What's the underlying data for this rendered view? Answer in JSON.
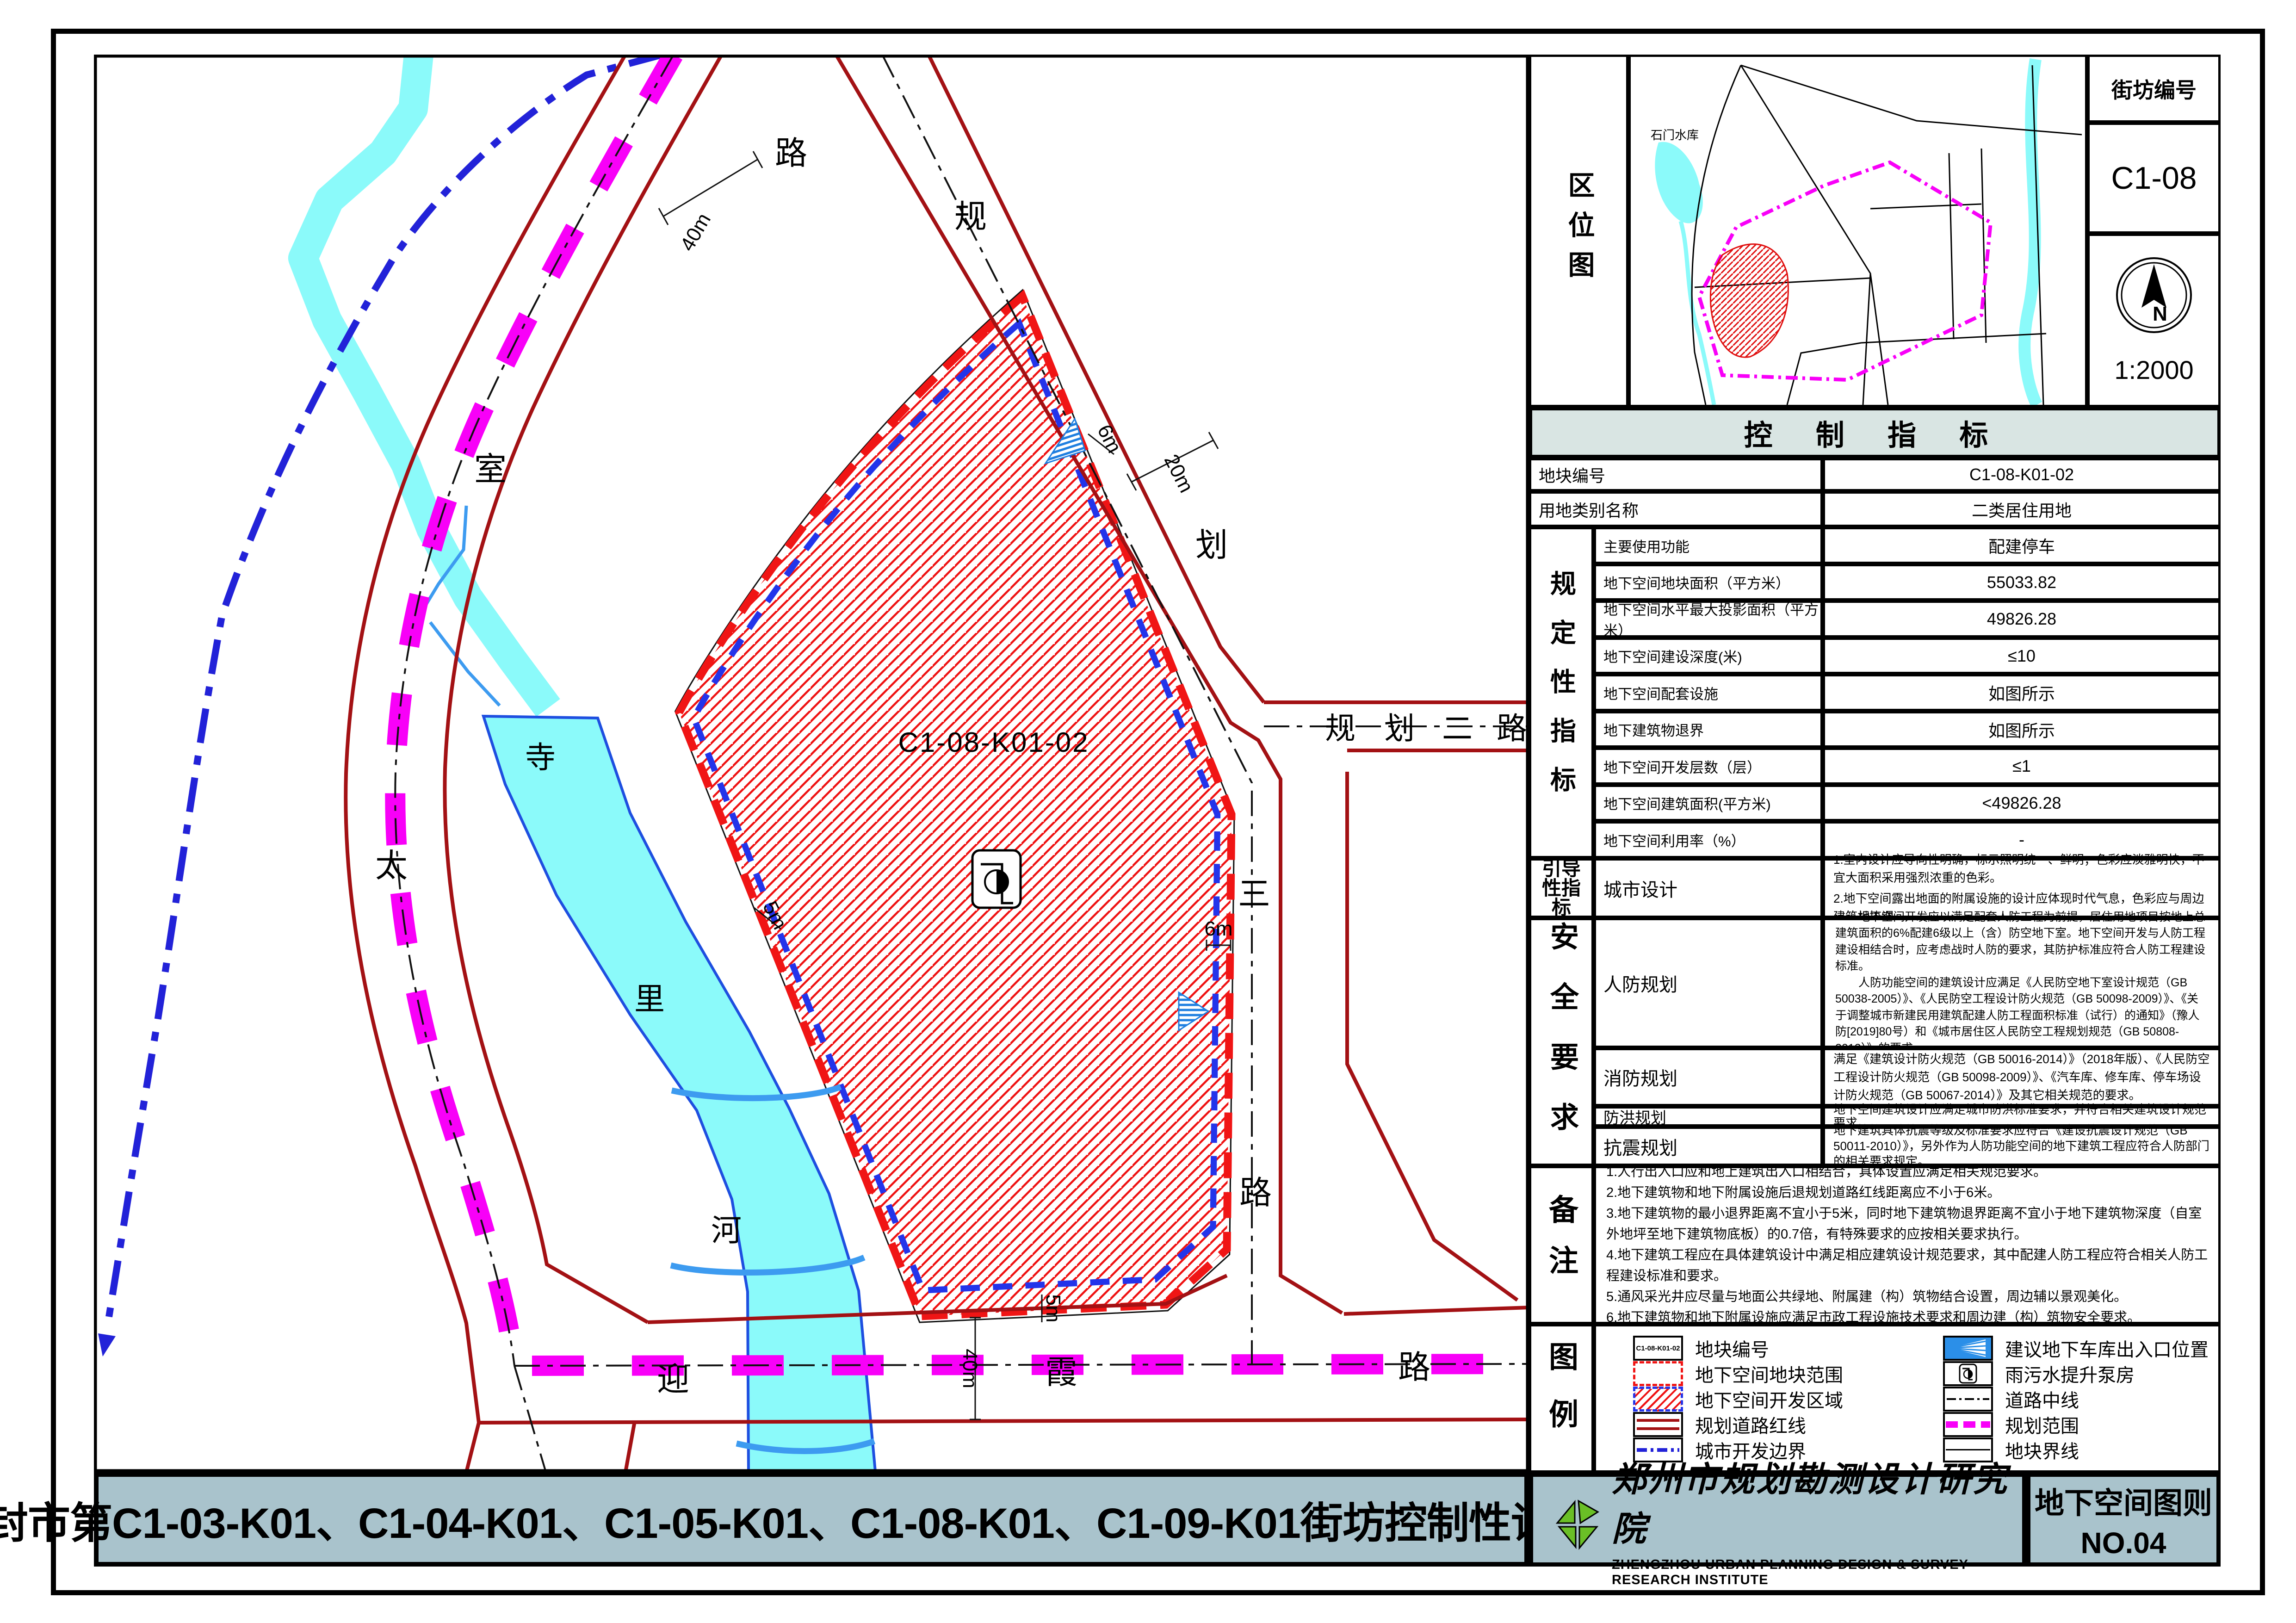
{
  "sheet": {
    "title_bar": "登封市第C1-03-K01、C1-04-K01、C1-05-K01、C1-08-K01、C1-09-K01街坊控制性详细规划",
    "footer": {
      "institute_cn": "郑州市规划勘测设计研究院",
      "institute_en": "ZHENGZHOU URBAN PLANNING DESIGN & SURVEY RESEARCH INSTITUTE",
      "sheet_name": "地下空间图则",
      "sheet_no": "NO.04"
    }
  },
  "location_map": {
    "label": "区位图",
    "block_no_label": "街坊编号",
    "block_no": "C1-08",
    "north_letter": "N",
    "scale": "1:2000",
    "reservoir": "石门水库"
  },
  "map": {
    "parcel_code": "C1-08-K01-02",
    "river_chars": [
      "寺",
      "里",
      "河"
    ],
    "taishi_road_chars": [
      "太",
      "室",
      "路"
    ],
    "guihua3_road_chars": [
      "规",
      "划",
      "三",
      "路"
    ],
    "guihua2_road_chars": [
      "规",
      "划",
      "二",
      "路"
    ],
    "yingxia_road_chars": [
      "迎",
      "霞",
      "路"
    ],
    "dims": {
      "d40_top": "40m",
      "d20": "20m",
      "d6_ne": "6m",
      "d6_e": "6m",
      "d5_w": "5m",
      "d5_s": "5m",
      "d40_bottom": "40m"
    }
  },
  "table": {
    "header": "控  制  指  标",
    "row_plot_no": {
      "label": "地块编号",
      "value": "C1-08-K01-02"
    },
    "row_landuse": {
      "label": "用地类别名称",
      "value": "二类居住用地"
    },
    "group_regulatory": "规定性指标",
    "spec_rows": [
      {
        "label": "主要使用功能",
        "value": "配建停车"
      },
      {
        "label": "地下空间地块面积（平方米）",
        "value": "55033.82"
      },
      {
        "label": "地下空间水平最大投影面积（平方米）",
        "value": "49826.28"
      },
      {
        "label": "地下空间建设深度(米)",
        "value": "≤10"
      },
      {
        "label": "地下空间配套设施",
        "value": "如图所示"
      },
      {
        "label": "地下建筑物退界",
        "value": "如图所示"
      },
      {
        "label": "地下空间开发层数（层）",
        "value": "≤1"
      },
      {
        "label": "地下空间建筑面积(平方米)",
        "value": "<49826.28"
      },
      {
        "label": "地下空间利用率（%）",
        "value": "-"
      }
    ],
    "group_guiding": "引导性指标",
    "urban_design": {
      "label": "城市设计",
      "line1": "1.室内设计应导向性明确，标示照明统一、鲜明；色彩应淡雅明快，不宜大面积采用强烈浓重的色彩。",
      "line2": "2.地下空间露出地面的附属设施的设计应体现时代气息，色彩应与周边建筑相协调。"
    },
    "group_safety": "安全要求",
    "civil_defense": {
      "label": "人防规划",
      "p1": "地下空间开发应以满足配套人防工程为前提，居住用地项目按地上总建筑面积的6%配建6级以上（含）防空地下室。地下空间开发与人防工程建设相结合时，应考虑战时人防的要求，其防护标准应符合人防工程建设标准。",
      "p2": "人防功能空间的建筑设计应满足《人民防空地下室设计规范（GB 50038-2005）》、《人民防空工程设计防火规范（GB 50098-2009）》、《关于调整城市新建民用建筑配建人防工程面积标准（试行）的通知》（豫人防[2019]80号）和《城市居住区人民防空工程规划规范（GB 50808-2013）》的要求。"
    },
    "fire": {
      "label": "消防规划",
      "text": "满足《建筑设计防火规范（GB 50016-2014）》（2018年版）、《人民防空工程设计防火规范（GB 50098-2009）》、《汽车库、修车库、停车场设计防火规范（GB 50067-2014）》及其它相关规范的要求。"
    },
    "flood": {
      "label": "防洪规划",
      "text": "地下空间建筑设计应满足城市防洪标准要求，并符合相关建筑设计规范要求。"
    },
    "seismic": {
      "label": "抗震规划",
      "text": "地下建筑具体抗震等级及标准要求应符合《建设抗震设计规范（GB 50011-2010）》，另外作为人防功能空间的地下建筑工程应符合人防部门的相关要求规定。"
    },
    "group_remarks": "备注",
    "remarks": [
      "1.人行出入口应和地上建筑出入口相结合，具体设置应满足相关规范要求。",
      "2.地下建筑物和地下附属设施后退规划道路红线距离应不小于6米。",
      "3.地下建筑物的最小退界距离不宜小于5米，同时地下建筑物退界距离不宜小于地下建筑物深度（自室外地坪至地下建筑物底板）的0.7倍，有特殊要求的应按相关要求执行。",
      "4.地下建筑工程应在具体建筑设计中满足相应建筑设计规范要求，其中配建人防工程应符合相关人防工程建设标准和要求。",
      "5.通风采光井应尽量与地面公共绿地、附属建（构）筑物结合设置，周边辅以景观美化。",
      "6.地下建筑物和地下附属设施应满足市政工程设施技术要求和周边建（构）筑物安全要求。"
    ],
    "group_legend": "图例",
    "legend_left": [
      {
        "name": "plot-number",
        "label": "地块编号",
        "icon_text": "C1-08-K01-02"
      },
      {
        "name": "underground-plot-extent",
        "label": "地下空间地块范围"
      },
      {
        "name": "underground-development-zone",
        "label": "地下空间开发区域"
      },
      {
        "name": "planned-road-redline",
        "label": "规划道路红线"
      },
      {
        "name": "urban-development-boundary",
        "label": "城市开发边界"
      }
    ],
    "legend_right": [
      {
        "name": "garage-entrance",
        "label": "建议地下车库出入口位置"
      },
      {
        "name": "pump-station",
        "label": "雨污水提升泵房"
      },
      {
        "name": "road-centerline",
        "label": "道路中线"
      },
      {
        "name": "planning-scope",
        "label": "规划范围"
      },
      {
        "name": "plot-boundary",
        "label": "地块界线"
      }
    ]
  },
  "colors": {
    "band_bg": "#a9c3cc",
    "header_bg": "#d9e5e3",
    "road_redline": "#a31114",
    "hatch_red": "#ef1212",
    "magenta": "#f800f8",
    "blue_dash": "#2334ea",
    "city_boundary_blue": "#2222d8",
    "river_fill": "#8bfafa",
    "river_edge": "#1e4fe0",
    "bridge_blue": "#3d9bf0",
    "logo_green": "#6abf26"
  }
}
